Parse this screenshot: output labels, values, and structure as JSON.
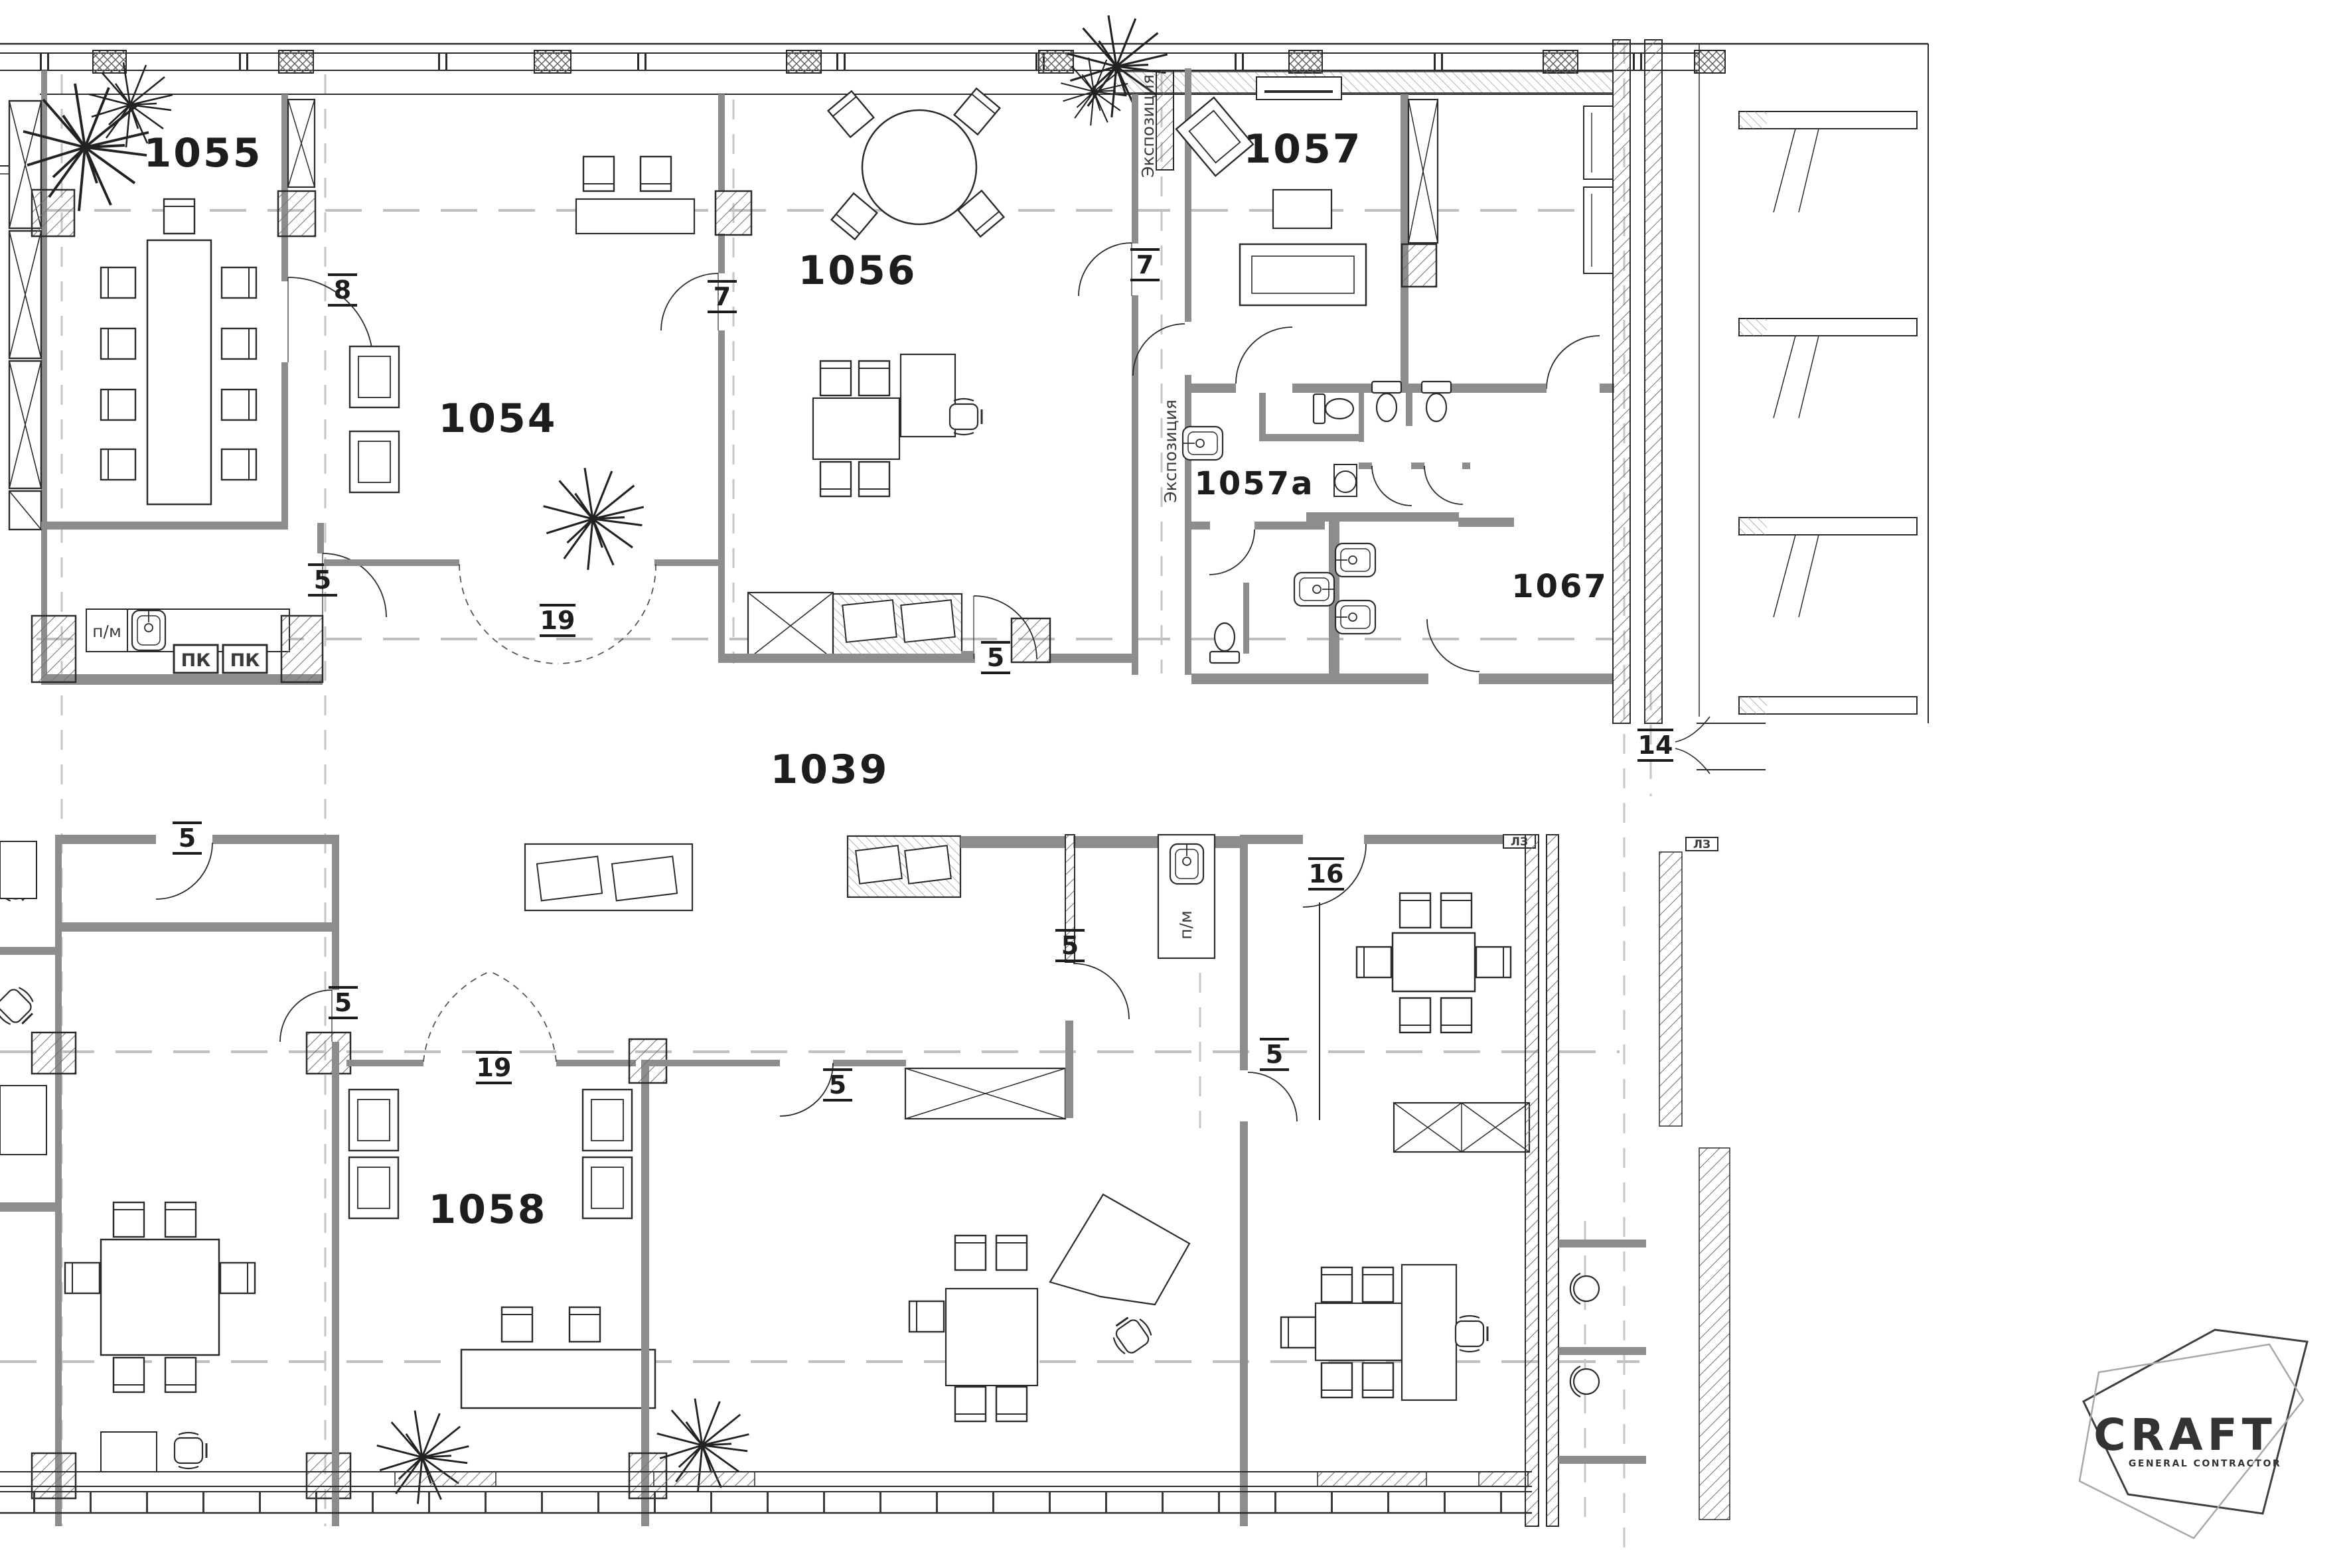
{
  "rooms": {
    "r1055": "1055",
    "r1054": "1054",
    "r1056": "1056",
    "r1057": "1057",
    "r1057a": "1057a",
    "r1067": "1067",
    "r1039": "1039",
    "r1058": "1058"
  },
  "tags": {
    "t8": "8",
    "t7_1054": "7",
    "t7_1056": "7",
    "t5_pm": "5",
    "t19_upper": "19",
    "t5_1056": "5",
    "t14": "14",
    "t5_lower_left": "5",
    "t16": "16",
    "t5_cabinet": "5",
    "t5_mid": "5",
    "t19_1058": "19",
    "t5_1058": "5",
    "t5_room16": "5"
  },
  "annotations": {
    "expo1": "Экспозиция",
    "expo2": "Экспозиция",
    "pm1": "п/м",
    "pm2": "п/м",
    "pk1": "ПК",
    "pk2": "ПК",
    "lz1": "ЛЗ",
    "lz2": "ЛЗ"
  },
  "logo": {
    "title": "CRAFT",
    "subtitle": "GENERAL CONTRACTOR"
  },
  "colors": {
    "wall": "#8d8d8d",
    "line": "#2b2b2b",
    "axis": "#bfbfbf"
  }
}
